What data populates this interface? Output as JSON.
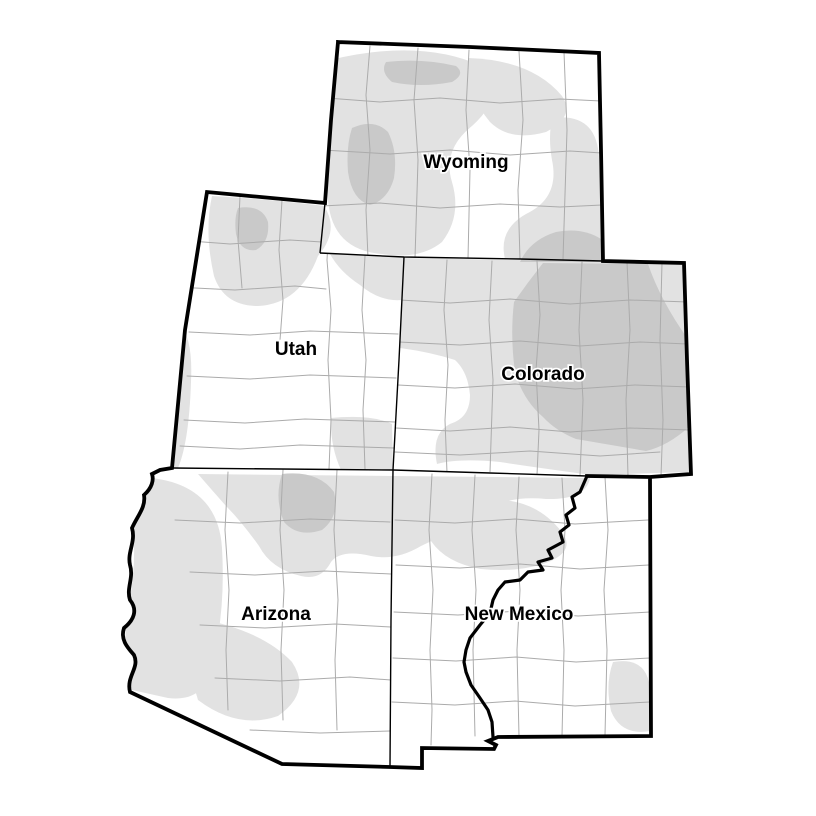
{
  "map": {
    "states": [
      {
        "id": "wyoming",
        "name": "Wyoming"
      },
      {
        "id": "utah",
        "name": "Utah"
      },
      {
        "id": "colorado",
        "name": "Colorado"
      },
      {
        "id": "arizona",
        "name": "Arizona"
      },
      {
        "id": "new-mexico",
        "name": "New Mexico"
      }
    ],
    "colors": {
      "background": "#ffffff",
      "shade_light": "#e2e2e2",
      "shade_dark": "#c9c9c9",
      "county_line": "#ababab",
      "state_border": "#000000",
      "label_halo": "#ffffff"
    }
  }
}
